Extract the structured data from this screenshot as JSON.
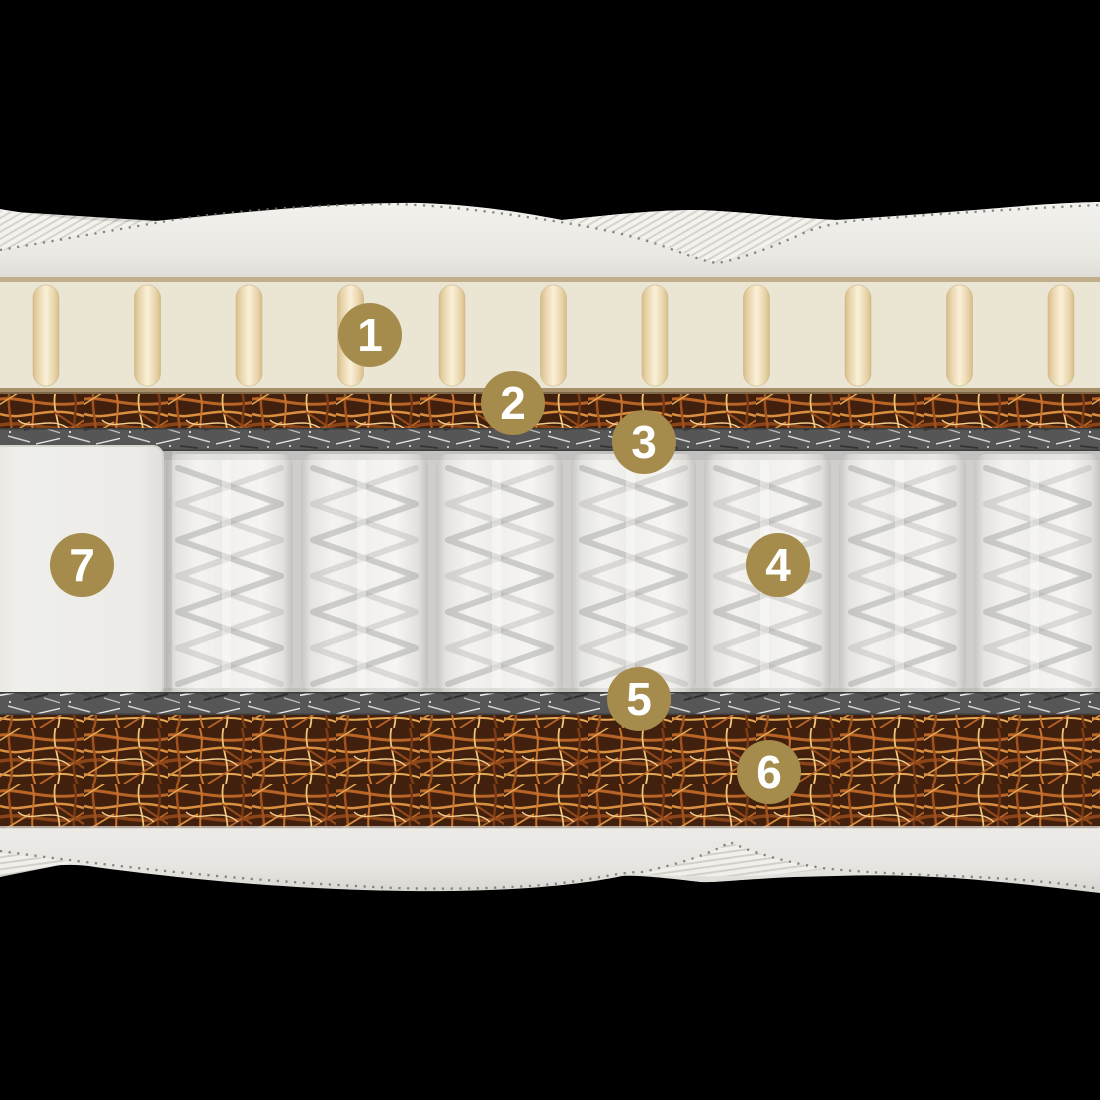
{
  "badges": [
    {
      "label": "1"
    },
    {
      "label": "2"
    },
    {
      "label": "3"
    },
    {
      "label": "4"
    },
    {
      "label": "5"
    },
    {
      "label": "6"
    },
    {
      "label": "7"
    }
  ],
  "colors": {
    "background": "#000000",
    "badge": "#a58b4c",
    "badge_text": "#ffffff",
    "cover": "#eceae5",
    "latex": "#ebe6d3",
    "latex_groove": "#f7edd5",
    "trim_line": "#c0ae8c",
    "coir": "#6e3a18",
    "felt": "#5c5c5c",
    "spring_pocket": "#f2f1ee",
    "seam": "#75726a"
  }
}
